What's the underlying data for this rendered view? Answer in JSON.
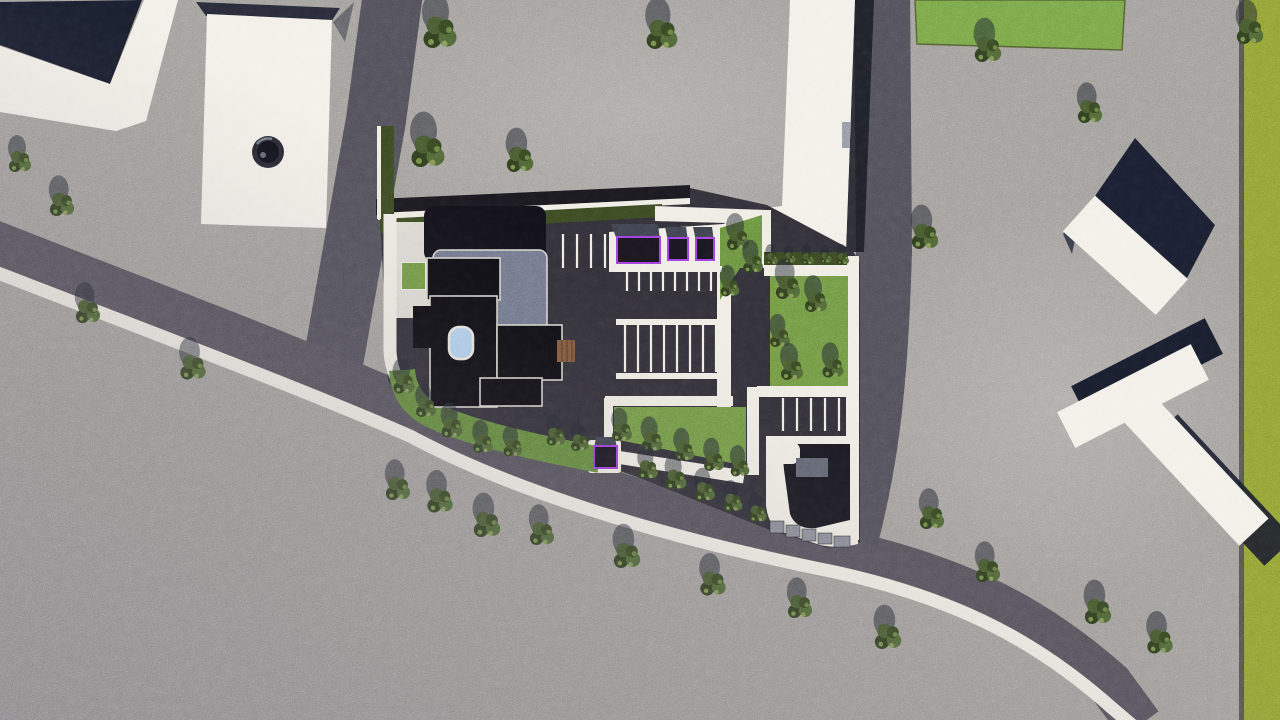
{
  "scene": {
    "description": "Top-down aerial 3D architectural site plan rendering with white buildings, dark asphalt parcel, parking rows, lawns, carports and roads",
    "colors": {
      "ground": "#9c9995",
      "road": "#4c4a53",
      "road_main": "#504d56",
      "sidewalk": "#eeebe2",
      "building_white": "#f2efe7",
      "shadow_navy": "#161a29",
      "site_asphalt": "#2d2b33",
      "roof_black": "#0c0b10",
      "roof_gray": "#6a7183",
      "parapet_white": "#d8d5cc",
      "grass": "#6b9140",
      "grass_top": "#72a043",
      "grass_olive": "#8a9c31",
      "hedge": "#36441f",
      "pool_blue": "#accdee",
      "car_trim_purple": "#9a3be0",
      "car_body": "#17141d",
      "carport_top": "#3a3d49",
      "deck_brown": "#7a5236",
      "wall_gray": "#80848f"
    },
    "trees": [
      [
        20,
        162,
        1.0
      ],
      [
        62,
        205,
        1.1
      ],
      [
        88,
        312,
        1.1
      ],
      [
        193,
        368,
        1.15
      ],
      [
        440,
        33,
        1.5
      ],
      [
        662,
        35,
        1.4
      ],
      [
        428,
        152,
        1.5
      ],
      [
        520,
        160,
        1.2
      ],
      [
        988,
        50,
        1.2
      ],
      [
        1090,
        112,
        1.1
      ],
      [
        925,
        237,
        1.2
      ],
      [
        1250,
        32,
        1.2
      ],
      [
        398,
        489,
        1.1
      ],
      [
        440,
        501,
        1.15
      ],
      [
        487,
        525,
        1.2
      ],
      [
        542,
        534,
        1.1
      ],
      [
        627,
        556,
        1.2
      ],
      [
        713,
        584,
        1.15
      ],
      [
        800,
        607,
        1.1
      ],
      [
        888,
        637,
        1.2
      ],
      [
        932,
        518,
        1.1
      ],
      [
        988,
        571,
        1.1
      ],
      [
        1098,
        612,
        1.2
      ],
      [
        1160,
        642,
        1.15
      ],
      [
        738,
        240,
        1.0
      ],
      [
        753,
        264,
        0.9
      ],
      [
        730,
        288,
        0.85
      ],
      [
        788,
        288,
        1.1
      ],
      [
        816,
        302,
        1.0
      ],
      [
        780,
        338,
        0.9
      ],
      [
        792,
        370,
        1.0
      ],
      [
        833,
        368,
        0.95
      ],
      [
        622,
        432,
        0.9
      ],
      [
        652,
        442,
        0.95
      ],
      [
        684,
        452,
        0.9
      ],
      [
        714,
        462,
        0.9
      ],
      [
        740,
        468,
        0.85
      ],
      [
        404,
        384,
        0.95
      ],
      [
        426,
        408,
        0.9
      ],
      [
        452,
        428,
        0.95
      ],
      [
        483,
        444,
        0.9
      ],
      [
        513,
        448,
        0.85
      ],
      [
        648,
        470,
        0.9
      ],
      [
        676,
        480,
        0.95
      ],
      [
        705,
        492,
        0.9
      ],
      [
        733,
        503,
        0.85
      ],
      [
        758,
        514,
        0.8
      ],
      [
        556,
        437,
        0.85
      ],
      [
        580,
        443,
        0.8
      ],
      [
        772,
        259,
        0.55
      ],
      [
        790,
        258,
        0.5
      ],
      [
        808,
        259,
        0.55
      ],
      [
        826,
        258,
        0.5
      ],
      [
        843,
        259,
        0.55
      ]
    ],
    "parking": {
      "stripe_rows": [
        {
          "x": [
            563,
            577,
            591,
            605
          ],
          "y1": 234,
          "y2": 268
        },
        {
          "x": [
            627,
            639,
            651,
            663,
            675,
            687,
            699,
            711
          ],
          "y1": 272,
          "y2": 291
        },
        {
          "x": [
            625,
            638,
            651,
            664,
            677,
            690,
            703,
            716
          ],
          "y1": 325,
          "y2": 372
        },
        {
          "x": [
            783,
            797,
            811,
            825,
            839
          ],
          "y1": 398,
          "y2": 431
        }
      ],
      "divider_bars": [
        [
          612,
          266,
          110,
          6
        ],
        [
          616,
          319,
          108,
          6
        ],
        [
          616,
          373,
          108,
          6
        ],
        [
          757,
          386,
          101,
          11
        ],
        [
          605,
          396,
          128,
          10
        ]
      ]
    },
    "carports": [
      {
        "body": [
          617,
          237,
          43,
          26
        ],
        "top": [
          611,
          224,
          47,
          16
        ]
      },
      {
        "body": [
          668,
          238,
          20,
          22
        ],
        "top": [
          665,
          227,
          21,
          13
        ]
      },
      {
        "body": [
          696,
          238,
          18,
          22
        ],
        "top": [
          693,
          227,
          19,
          13
        ]
      },
      {
        "body": [
          594,
          446,
          23,
          22
        ],
        "top": [
          596,
          437,
          19,
          11
        ]
      }
    ]
  }
}
